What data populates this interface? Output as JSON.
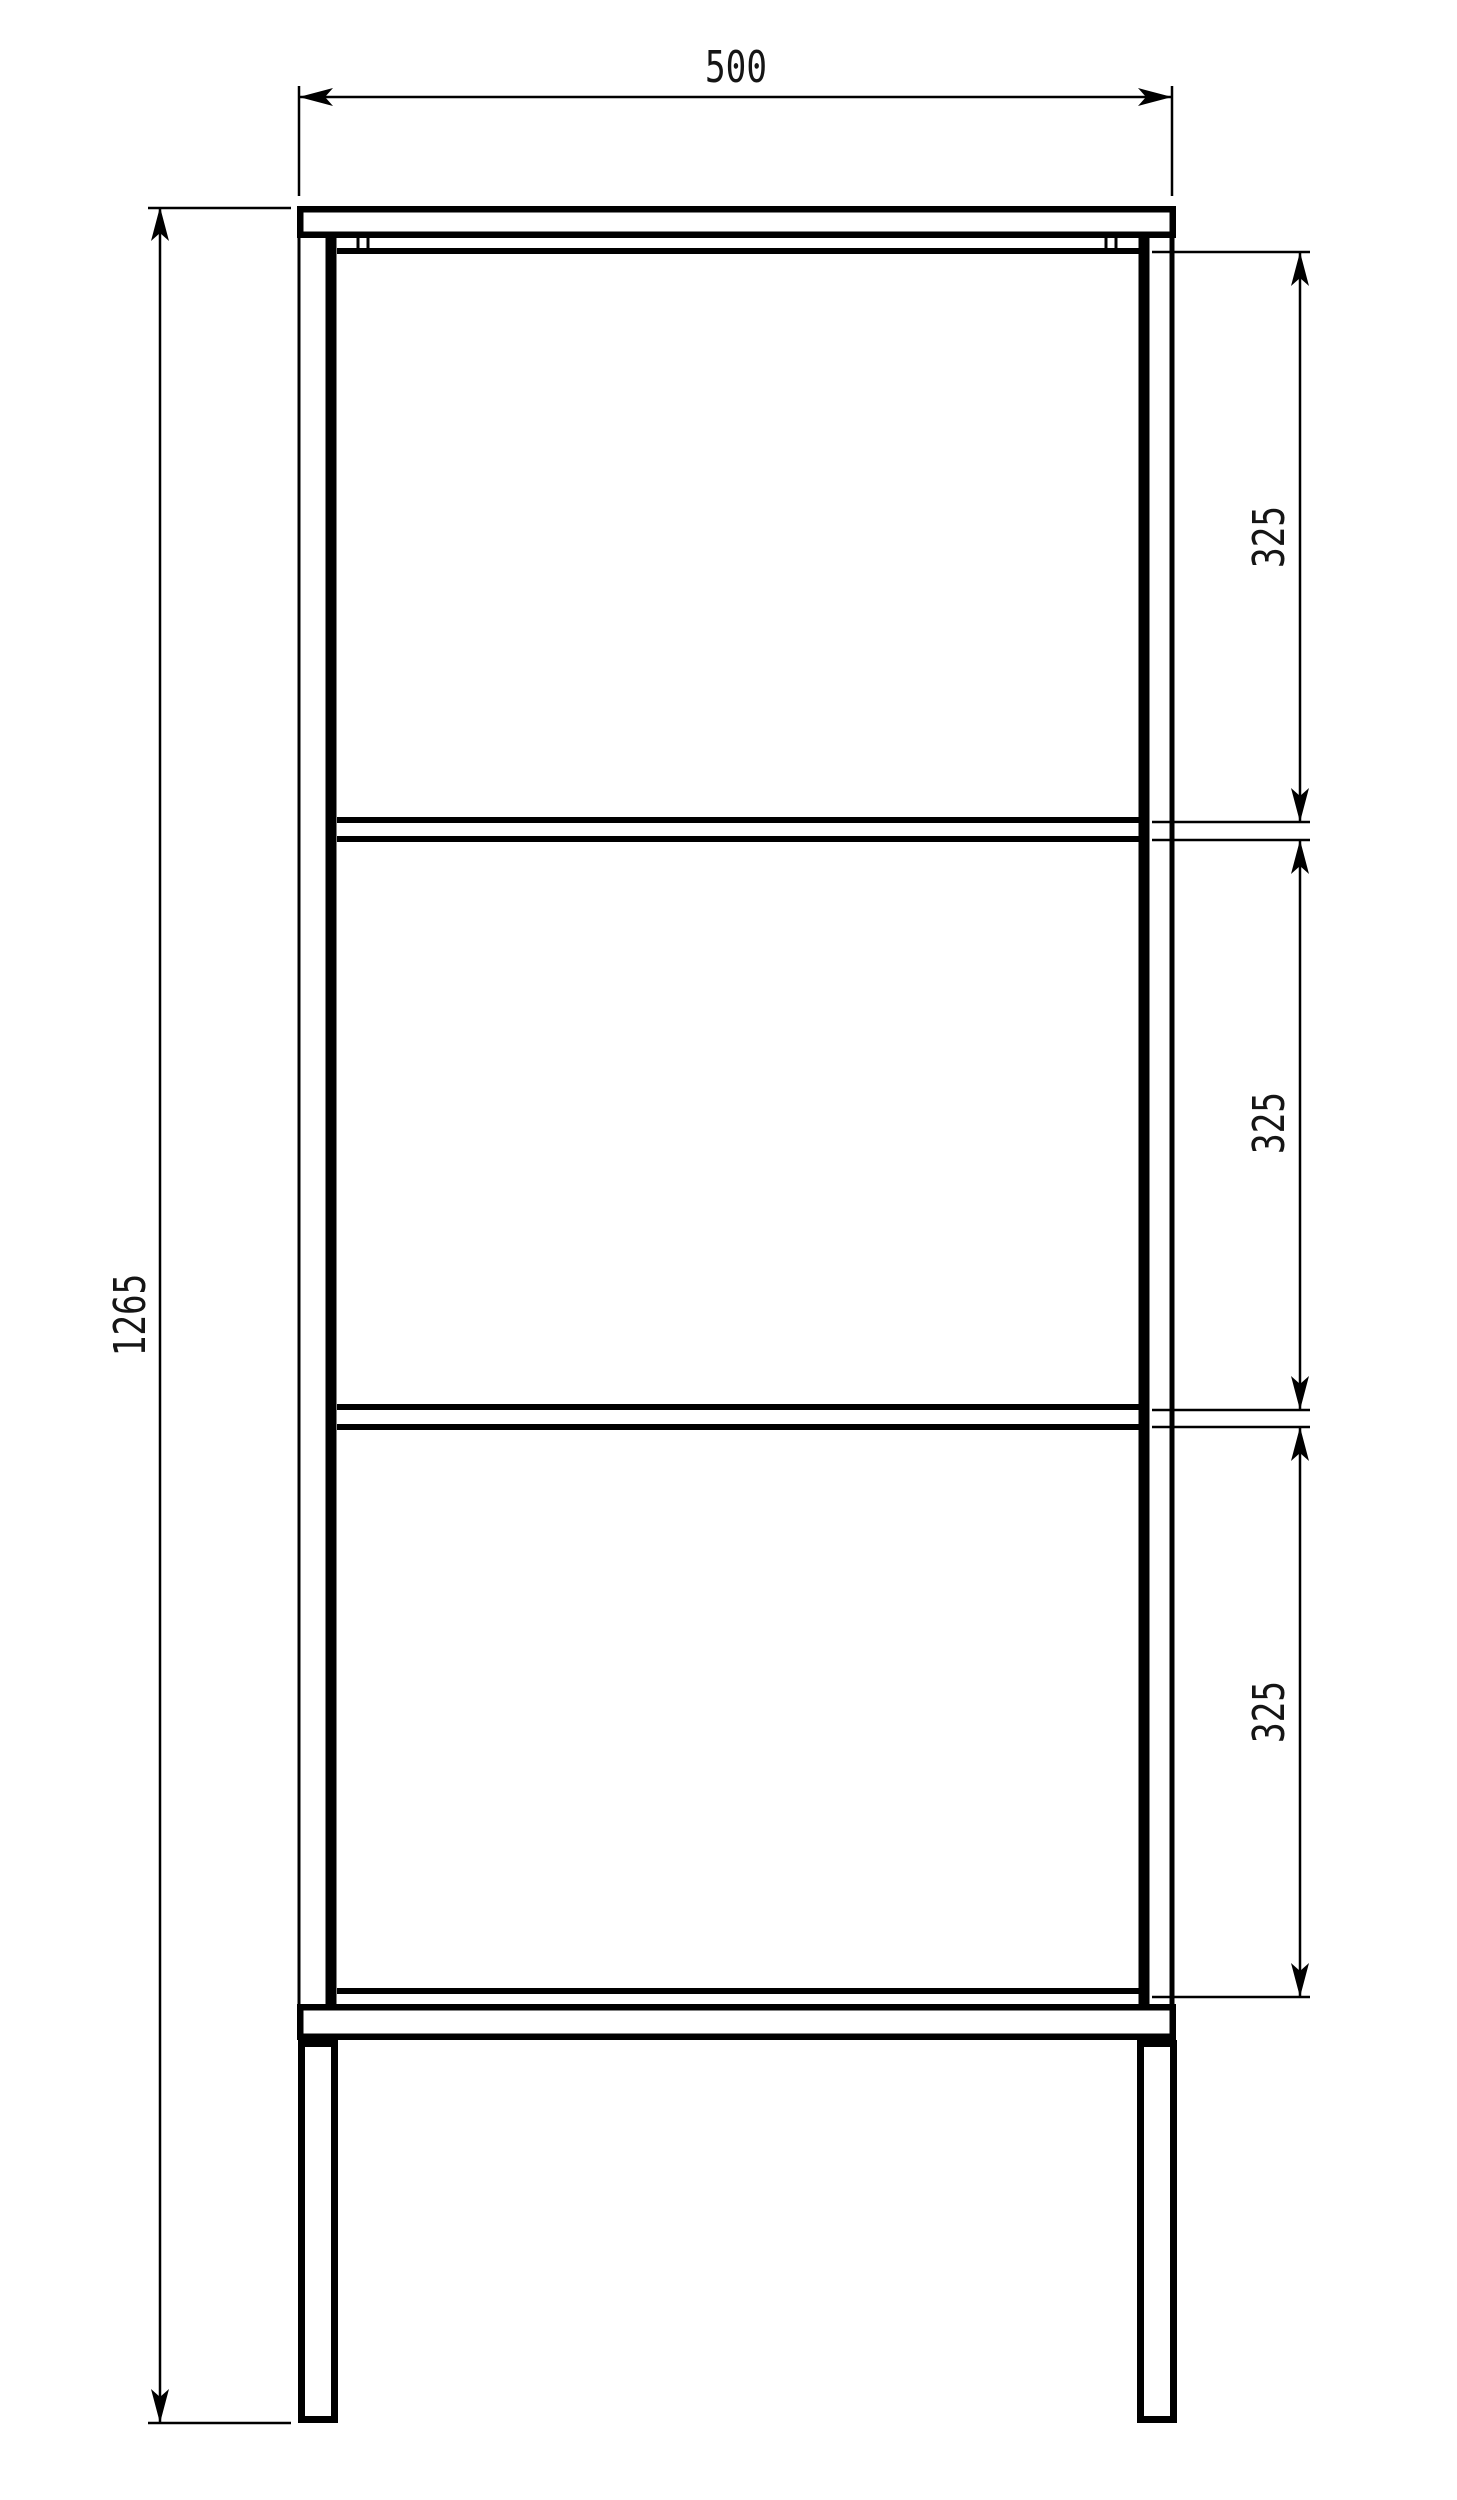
{
  "document": {
    "type": "technical-drawing",
    "view": "front-elevation",
    "subject": "three-shelf open frame rack with top panel, bottom stretcher and four legs"
  },
  "dimensions": {
    "width": {
      "label": "500",
      "value": 500,
      "orientation": "horizontal"
    },
    "height": {
      "label": "1265",
      "value": 1265,
      "orientation": "vertical"
    },
    "shelf_spacings": [
      {
        "label": "325",
        "value": 325,
        "orientation": "vertical"
      },
      {
        "label": "325",
        "value": 325,
        "orientation": "vertical"
      },
      {
        "label": "325",
        "value": 325,
        "orientation": "vertical"
      }
    ]
  },
  "colors": {
    "line": "#000000",
    "text": "#151515",
    "background": "#ffffff"
  },
  "drawing": {
    "rects": [
      {
        "name": "top-panel",
        "x": 297,
        "y": 206,
        "w": 879,
        "h": 32,
        "s": 6.5
      },
      {
        "name": "bottom-stretcher",
        "x": 297,
        "y": 2004,
        "w": 879,
        "h": 36,
        "s": 6.5
      },
      {
        "name": "left-leg",
        "x": 298,
        "y": 2040,
        "w": 40,
        "h": 383,
        "s": 7
      },
      {
        "name": "right-leg",
        "x": 1137,
        "y": 2040,
        "w": 40,
        "h": 383,
        "s": 7
      }
    ],
    "vlines": [
      {
        "name": "left-post-outer-edge",
        "x": 299,
        "y1": 238,
        "y2": 2006,
        "w": 3
      },
      {
        "name": "left-post-inner-edge",
        "x": 331,
        "y1": 238,
        "y2": 2006,
        "w": 11
      },
      {
        "name": "right-post-inner-edge",
        "x": 1144,
        "y1": 238,
        "y2": 2006,
        "w": 11
      },
      {
        "name": "right-post-outer-edge",
        "x": 1172,
        "y1": 238,
        "y2": 2006,
        "w": 5
      },
      {
        "name": "back-post-edge-tick",
        "x": 358,
        "y1": 236,
        "y2": 254,
        "w": 3
      },
      {
        "name": "back-post-edge-tick",
        "x": 368,
        "y1": 236,
        "y2": 254,
        "w": 3
      },
      {
        "name": "back-post-edge-tick",
        "x": 1106,
        "y1": 236,
        "y2": 254,
        "w": 3
      },
      {
        "name": "back-post-edge-tick",
        "x": 1116,
        "y1": 236,
        "y2": 254,
        "w": 3
      }
    ],
    "hlines": [
      {
        "name": "top-rail",
        "x1": 337,
        "x2": 1139,
        "y": 251,
        "w": 6
      },
      {
        "name": "shelf-1-top-edge",
        "x1": 337,
        "x2": 1139,
        "y": 820,
        "w": 6
      },
      {
        "name": "shelf-1-bottom-edge",
        "x1": 337,
        "x2": 1139,
        "y": 839,
        "w": 6
      },
      {
        "name": "shelf-2-top-edge",
        "x1": 337,
        "x2": 1139,
        "y": 1407,
        "w": 6
      },
      {
        "name": "shelf-2-bottom-edge",
        "x1": 337,
        "x2": 1139,
        "y": 1427,
        "w": 6
      },
      {
        "name": "bottom-rail",
        "x1": 337,
        "x2": 1139,
        "y": 1991,
        "w": 6
      }
    ],
    "dims": [
      {
        "name": "dim-width-500",
        "line": {
          "x1": 299,
          "y1": 97,
          "x2": 1172,
          "y2": 97
        },
        "exts": [
          {
            "x1": 299,
            "y1": 86,
            "x2": 299,
            "y2": 196
          },
          {
            "x1": 1172,
            "y1": 86,
            "x2": 1172,
            "y2": 196
          }
        ],
        "arrows": [
          {
            "x": 299,
            "y": 97,
            "dir": "left"
          },
          {
            "x": 1172,
            "y": 97,
            "dir": "right"
          }
        ]
      },
      {
        "name": "dim-height-1265",
        "line": {
          "x1": 160,
          "y1": 207,
          "x2": 160,
          "y2": 2423
        },
        "exts": [
          {
            "x1": 148,
            "y1": 208,
            "x2": 291,
            "y2": 208
          },
          {
            "x1": 148,
            "y1": 2423,
            "x2": 291,
            "y2": 2423
          }
        ],
        "arrows": [
          {
            "x": 160,
            "y": 207,
            "dir": "up"
          },
          {
            "x": 160,
            "y": 2423,
            "dir": "down"
          }
        ]
      },
      {
        "name": "dim-spacing-1-325",
        "line": {
          "x1": 1300,
          "y1": 252,
          "x2": 1300,
          "y2": 822
        },
        "exts": [
          {
            "x1": 1152,
            "y1": 252,
            "x2": 1310,
            "y2": 252
          },
          {
            "x1": 1152,
            "y1": 822,
            "x2": 1310,
            "y2": 822
          }
        ],
        "arrows": [
          {
            "x": 1300,
            "y": 252,
            "dir": "up"
          },
          {
            "x": 1300,
            "y": 822,
            "dir": "down"
          }
        ]
      },
      {
        "name": "dim-spacing-2-325",
        "line": {
          "x1": 1300,
          "y1": 840,
          "x2": 1300,
          "y2": 1410
        },
        "exts": [
          {
            "x1": 1152,
            "y1": 840,
            "x2": 1310,
            "y2": 840
          },
          {
            "x1": 1152,
            "y1": 1410,
            "x2": 1310,
            "y2": 1410
          }
        ],
        "arrows": [
          {
            "x": 1300,
            "y": 840,
            "dir": "up"
          },
          {
            "x": 1300,
            "y": 1410,
            "dir": "down"
          }
        ]
      },
      {
        "name": "dim-spacing-3-325",
        "line": {
          "x1": 1300,
          "y1": 1427,
          "x2": 1300,
          "y2": 1997
        },
        "exts": [
          {
            "x1": 1152,
            "y1": 1427,
            "x2": 1310,
            "y2": 1427
          },
          {
            "x1": 1152,
            "y1": 1997,
            "x2": 1310,
            "y2": 1997
          }
        ],
        "arrows": [
          {
            "x": 1300,
            "y": 1427,
            "dir": "up"
          },
          {
            "x": 1300,
            "y": 1997,
            "dir": "down"
          }
        ]
      }
    ],
    "arrow_shape": {
      "length": 34,
      "half_width": 9,
      "notch": 26
    },
    "stroke_dim": 2.5
  }
}
